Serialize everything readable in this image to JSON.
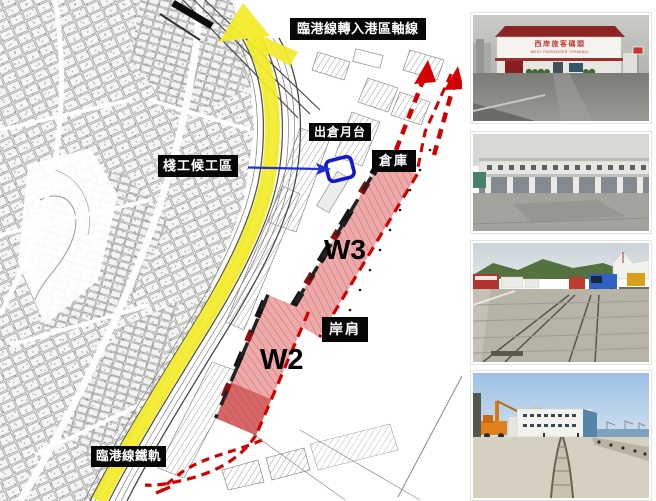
{
  "map": {
    "labels": {
      "axis_line": "臨港線轉入港區軸線",
      "worker_waiting_area": "棧工候工區",
      "outbound_platform": "出倉月台",
      "warehouse": "倉庫",
      "quay_shoulder": "岸肩",
      "harbor_rail_track": "臨港線鐵軌"
    },
    "zones": {
      "w3": "W3",
      "w2": "W2"
    },
    "colors": {
      "route_yellow": "#f3ec28",
      "zone_pink": "#ecaaaa",
      "accent_red": "#d40000",
      "marker_blue": "#1717cf",
      "label_bg": "#070707",
      "label_text": "#ffffff"
    }
  },
  "photos": {
    "terminal": {
      "sign_zh": "西岸旅客碼頭",
      "sign_en": "WEST PASSENGER TERMINAL"
    }
  }
}
